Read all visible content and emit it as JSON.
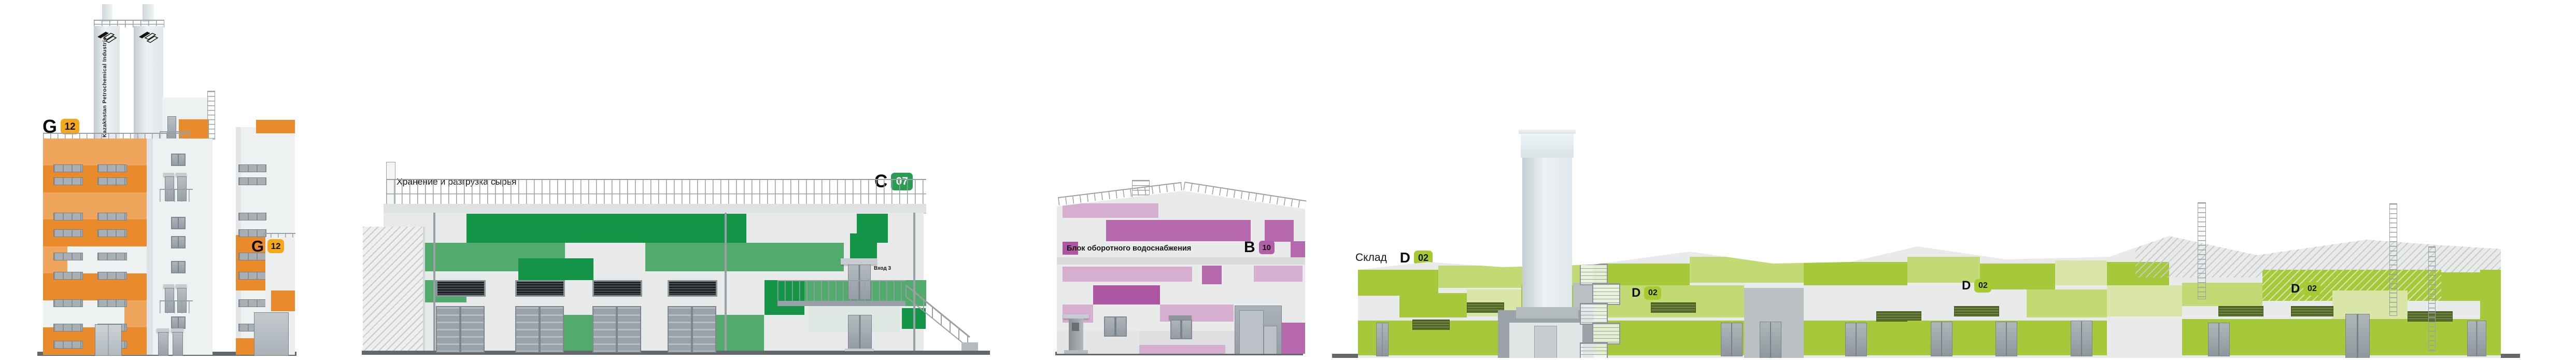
{
  "buildings": {
    "g": {
      "code_letter": "G",
      "code_number": "12",
      "chimney_text": "Kazakhstan Petrochemical Industries",
      "colors": {
        "light": "#F0A55C",
        "dark": "#E98A2B",
        "badge": "#F6A81C"
      }
    },
    "c": {
      "title": "Хранение и разгрузка сырья",
      "code_letter": "C",
      "code_number": "07",
      "entrance_label": "Вход 3",
      "colors": {
        "dark": "#149447",
        "mid": "#52AB6C",
        "badge": "#2A9E50"
      }
    },
    "b": {
      "title": "Блок оборотного водоснабжения",
      "code_letter": "B",
      "code_number": "10",
      "colors": {
        "dark": "#AD56A1",
        "mid": "#B668AC",
        "light": "#D5AED0",
        "badge": "#B160A7"
      }
    },
    "d": {
      "title": "Склад",
      "code_letter": "D",
      "code_number": "02",
      "colors": {
        "bright": "#A5C93B",
        "light": "#C3DA74",
        "pale": "#DAE6A7",
        "badge": "#A6CA2F"
      }
    }
  }
}
